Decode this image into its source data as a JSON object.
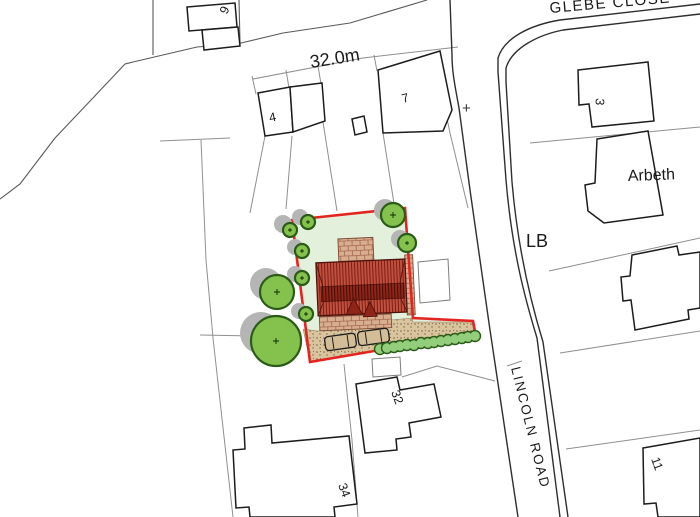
{
  "map": {
    "street_names": {
      "glebe_close": "GLEBE CLOSE",
      "lincoln_road": "LINCOLN ROAD"
    },
    "annotations": {
      "frontage_dimension": "32.0m",
      "letter_box": "LB",
      "house_name": "Arbeth",
      "survey_cross": "+"
    },
    "house_numbers": {
      "no6": "6",
      "no4": "4",
      "no7": "7",
      "no3": "3",
      "no32": "32",
      "no34": "34",
      "no11": "11"
    },
    "colors": {
      "site_boundary_red": "#e4251f",
      "garden_green": "#e2f0dc",
      "roof_main": "#bf4f3e",
      "roof_ridge_band": "#8e2518",
      "brick_paving": "#d8ae90",
      "driveway_gravel": "#d9c59d",
      "tree_fill": "#85c24d",
      "tree_outline": "#2a5c17",
      "hedge_fill": "#93ce7c",
      "tree_shadow_grey": "#b5b5b5",
      "building_outline": "#1c1c1c",
      "plot_line_grey": "#8f8f8f"
    }
  }
}
